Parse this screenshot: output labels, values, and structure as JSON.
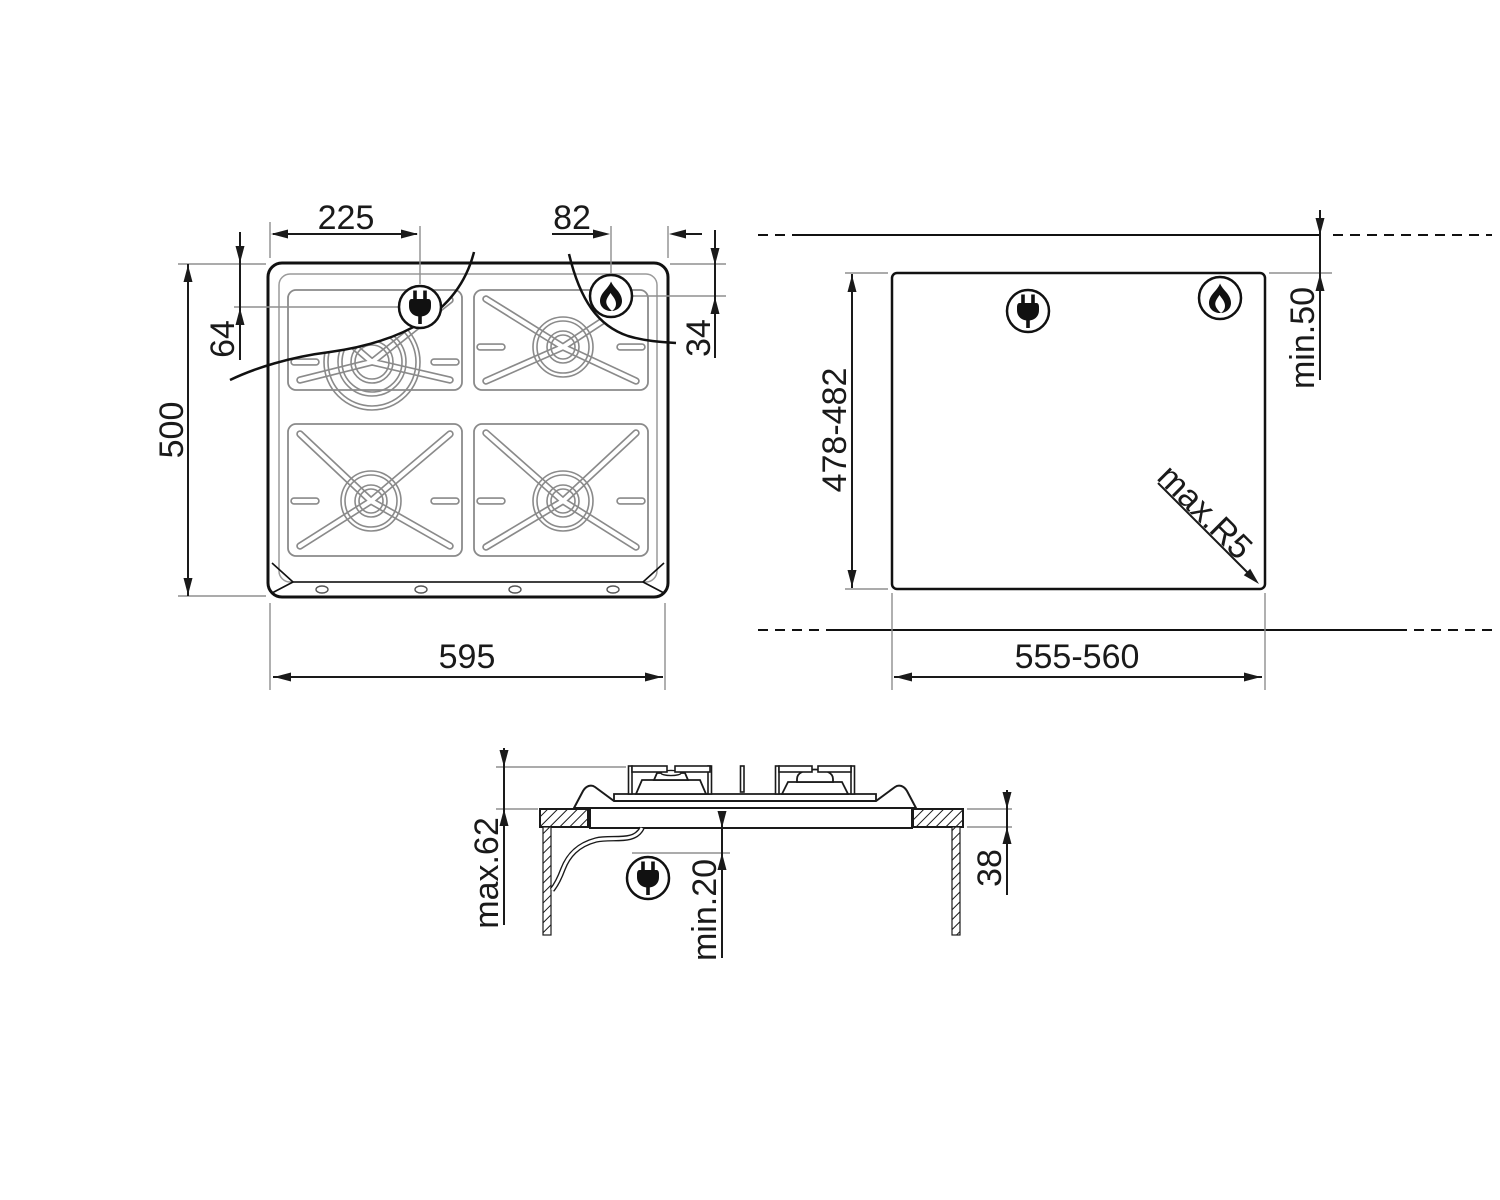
{
  "page": {
    "background": "#ffffff",
    "line_color": "#1a1a1a",
    "detail_line_color": "#8a8a8a",
    "extension_line_color": "#8f8f8f"
  },
  "top_view": {
    "dim_width": "595",
    "dim_height": "500",
    "dim_plug_from_left": "225",
    "dim_plug_from_top": "64",
    "dim_gas_from_right": "82",
    "dim_gas_from_top": "34"
  },
  "cutout_view": {
    "dim_width": "555-560",
    "dim_height": "478-482",
    "dim_rear_clearance": "min.50",
    "dim_corner_radius": "max.R5"
  },
  "side_view": {
    "dim_total_height": "max.62",
    "dim_clearance_below": "min.20",
    "dim_worktop_thickness": "38"
  },
  "icons": {
    "plug": "power-plug-icon",
    "flame": "gas-flame-icon"
  }
}
